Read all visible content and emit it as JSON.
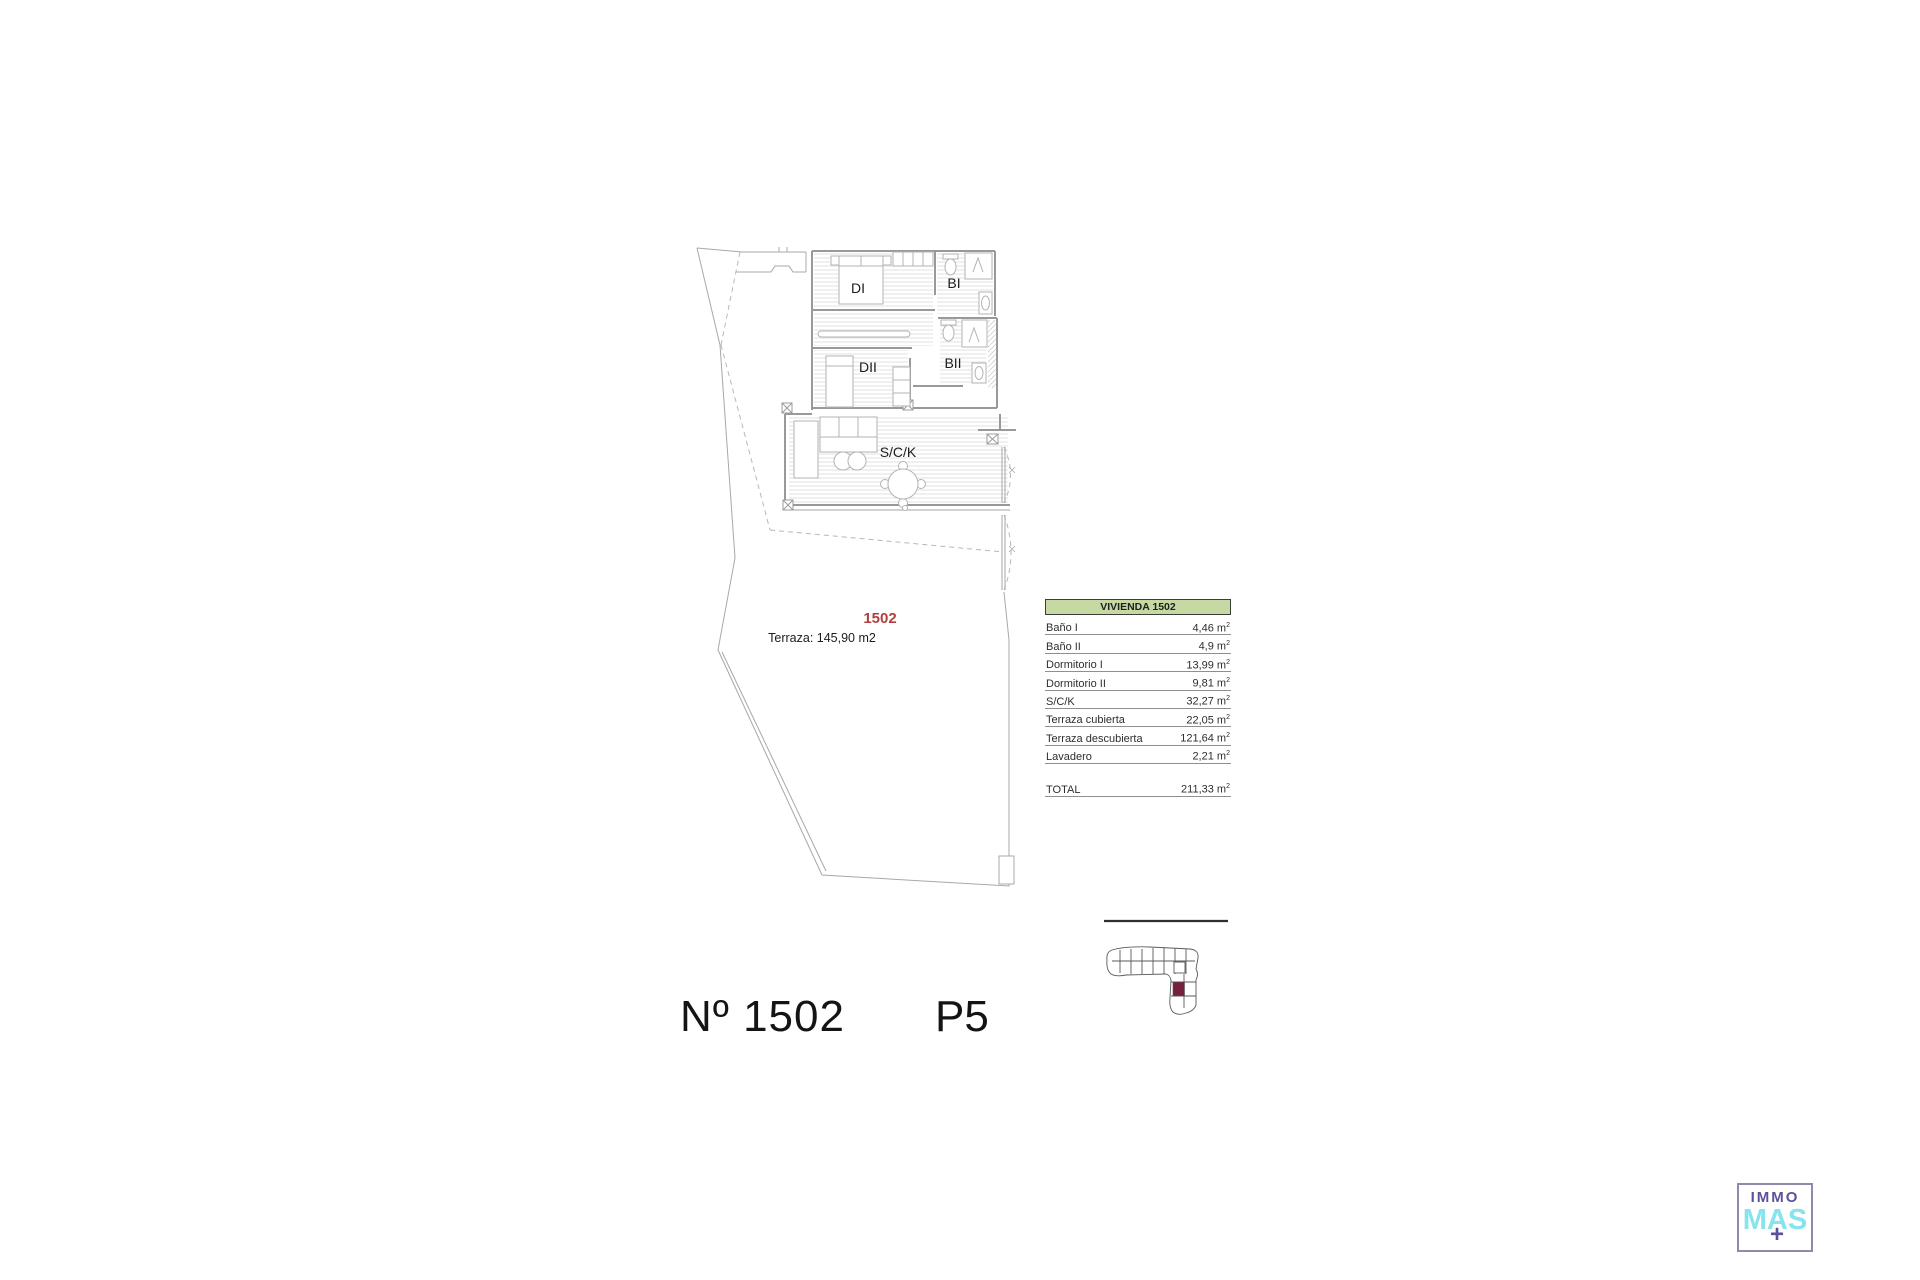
{
  "plan": {
    "room_labels": {
      "di": "DI",
      "bi": "BI",
      "dii": "DII",
      "bii": "BII",
      "sck": "S/C/K"
    },
    "unit_number": "1502",
    "unit_number_color": "#b43e3e",
    "terrace_note": "Terraza: 145,90 m2"
  },
  "area_table": {
    "header": "VIVIENDA 1502",
    "header_bg": "#c6d9a2",
    "unit": "m",
    "unit_sup": "2",
    "rows": [
      {
        "label": "Baño I",
        "value": "4,46"
      },
      {
        "label": "Baño II",
        "value": "4,9"
      },
      {
        "label": "Dormitorio I",
        "value": "13,99"
      },
      {
        "label": "Dormitorio II",
        "value": "9,81"
      },
      {
        "label": "S/C/K",
        "value": "32,27"
      },
      {
        "label": "Terraza cubierta",
        "value": "22,05"
      },
      {
        "label": "Terraza descubierta",
        "value": "121,64"
      },
      {
        "label": "Lavadero",
        "value": "2,21"
      }
    ],
    "total": {
      "label": "TOTAL",
      "value": "211,33"
    }
  },
  "footer": {
    "unit_no": "Nº 1502",
    "floor": "P5"
  },
  "locator": {
    "highlight_color": "#75203f"
  },
  "logo": {
    "line1": "IMMO",
    "line2": "MAS",
    "plus": "+",
    "purple": "#5a529b",
    "cyan": "#87e4ec",
    "border": "#8f8aac"
  }
}
